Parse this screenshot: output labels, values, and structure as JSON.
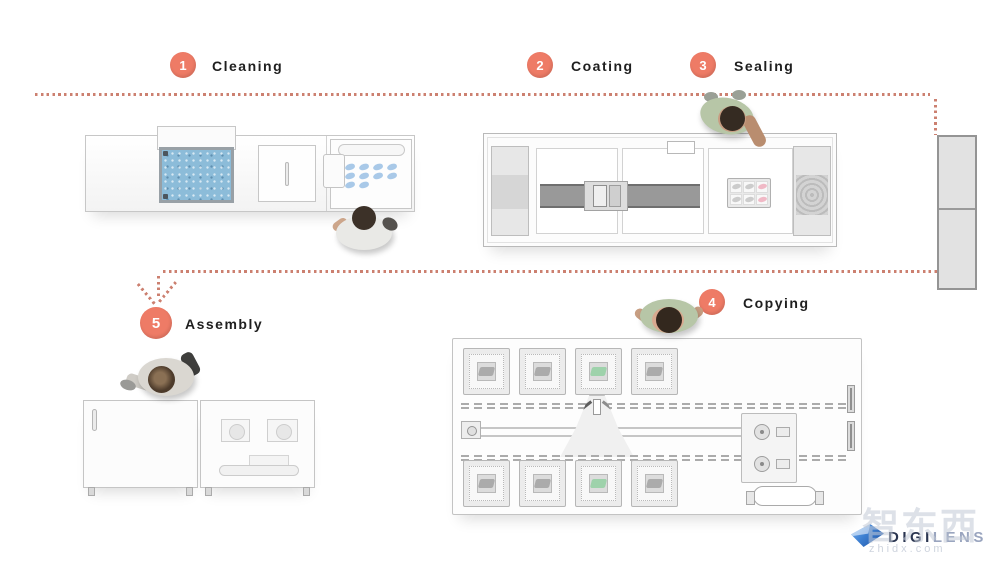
{
  "flow": {
    "steps": [
      {
        "number": "1",
        "label": "Cleaning"
      },
      {
        "number": "2",
        "label": "Coating"
      },
      {
        "number": "3",
        "label": "Sealing"
      },
      {
        "number": "4",
        "label": "Copying"
      },
      {
        "number": "5",
        "label": "Assembly"
      }
    ]
  },
  "logo": {
    "brand_prefix": "DIGI",
    "brand_suffix": "LENS"
  },
  "watermark": {
    "line1": "智东西",
    "line2": "zhidx.com"
  },
  "colors": {
    "accent": "#ee7b66",
    "dot": "#cc8070",
    "tank_blue": "#8cbcd9",
    "lens_green": "#9ed2ab",
    "lens_pink": "#f0b9c6",
    "belt_gray": "#999999",
    "logo_blue": "#3d7fd1",
    "logo_dark": "#2a3550",
    "logo_light": "#9aa5bf",
    "watermark": "#c3cad6"
  }
}
